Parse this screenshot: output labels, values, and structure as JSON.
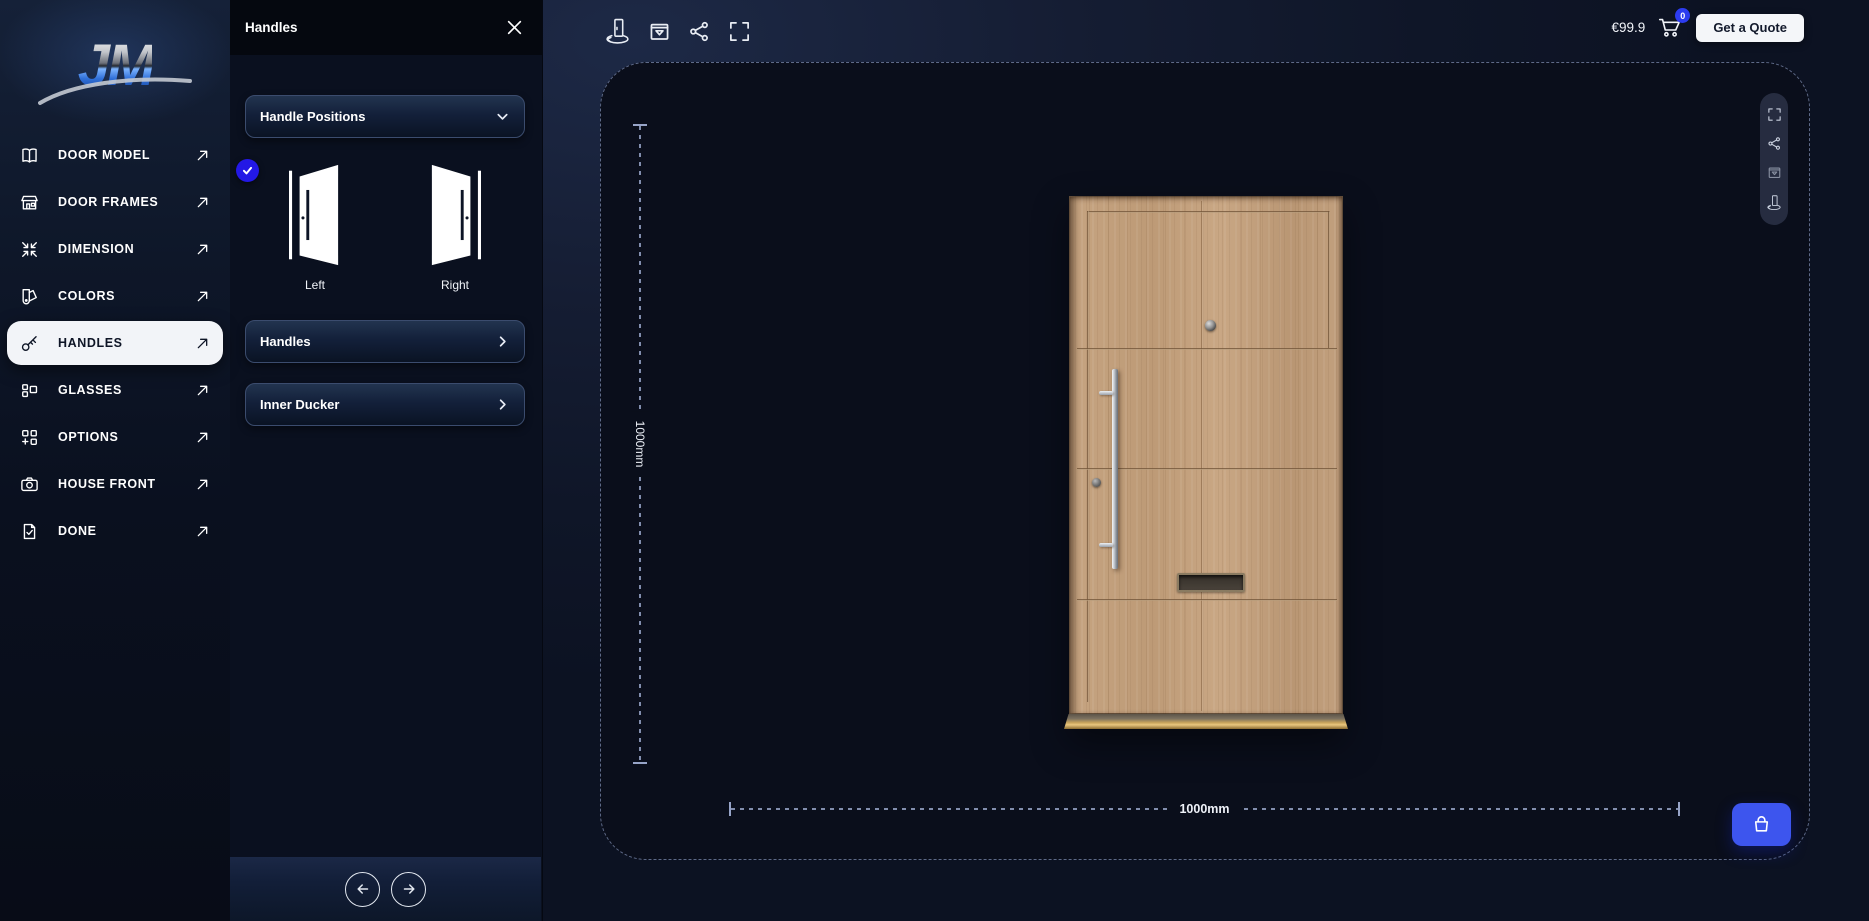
{
  "app": {
    "logo_text": "JM"
  },
  "sidebar": {
    "items": [
      {
        "label": "DOOR MODEL",
        "icon": "book-icon",
        "active": false
      },
      {
        "label": "DOOR FRAMES",
        "icon": "storefront-icon",
        "active": false
      },
      {
        "label": "DIMENSION",
        "icon": "compress-arrows-icon",
        "active": false
      },
      {
        "label": "COLORS",
        "icon": "swatch-icon",
        "active": false
      },
      {
        "label": "HANDLES",
        "icon": "key-icon",
        "active": true
      },
      {
        "label": "GLASSES",
        "icon": "glass-panels-icon",
        "active": false
      },
      {
        "label": "OPTIONS",
        "icon": "grid-plus-icon",
        "active": false
      },
      {
        "label": "HOUSE FRONT",
        "icon": "camera-icon",
        "active": false
      },
      {
        "label": "DONE",
        "icon": "file-check-icon",
        "active": false
      }
    ]
  },
  "panel": {
    "title": "Handles",
    "dropdown_label": "Handle Positions",
    "positions": [
      {
        "label": "Left",
        "selected": true
      },
      {
        "label": "Right",
        "selected": false
      }
    ],
    "accordions": [
      {
        "label": "Handles"
      },
      {
        "label": "Inner Ducker"
      }
    ]
  },
  "topbar": {
    "price": "€99.9",
    "cart_count": "0",
    "quote_label": "Get a Quote",
    "tool_icons": [
      "door-rotate-icon",
      "box-preview-icon",
      "share-icon",
      "fullscreen-icon"
    ]
  },
  "viewer": {
    "height_label": "1000mm",
    "width_label": "1000mm",
    "rail_icons": [
      "fullscreen-icon",
      "share-icon",
      "box-preview-icon",
      "door-rotate-icon"
    ]
  },
  "colors": {
    "accent_blue": "#2318e6",
    "action_blue": "#3d55ee",
    "badge_blue": "#2c3cf0",
    "wood_base": "#c2a07e",
    "brass": "#e9c67e",
    "active_pill": "#f2f4f8"
  }
}
